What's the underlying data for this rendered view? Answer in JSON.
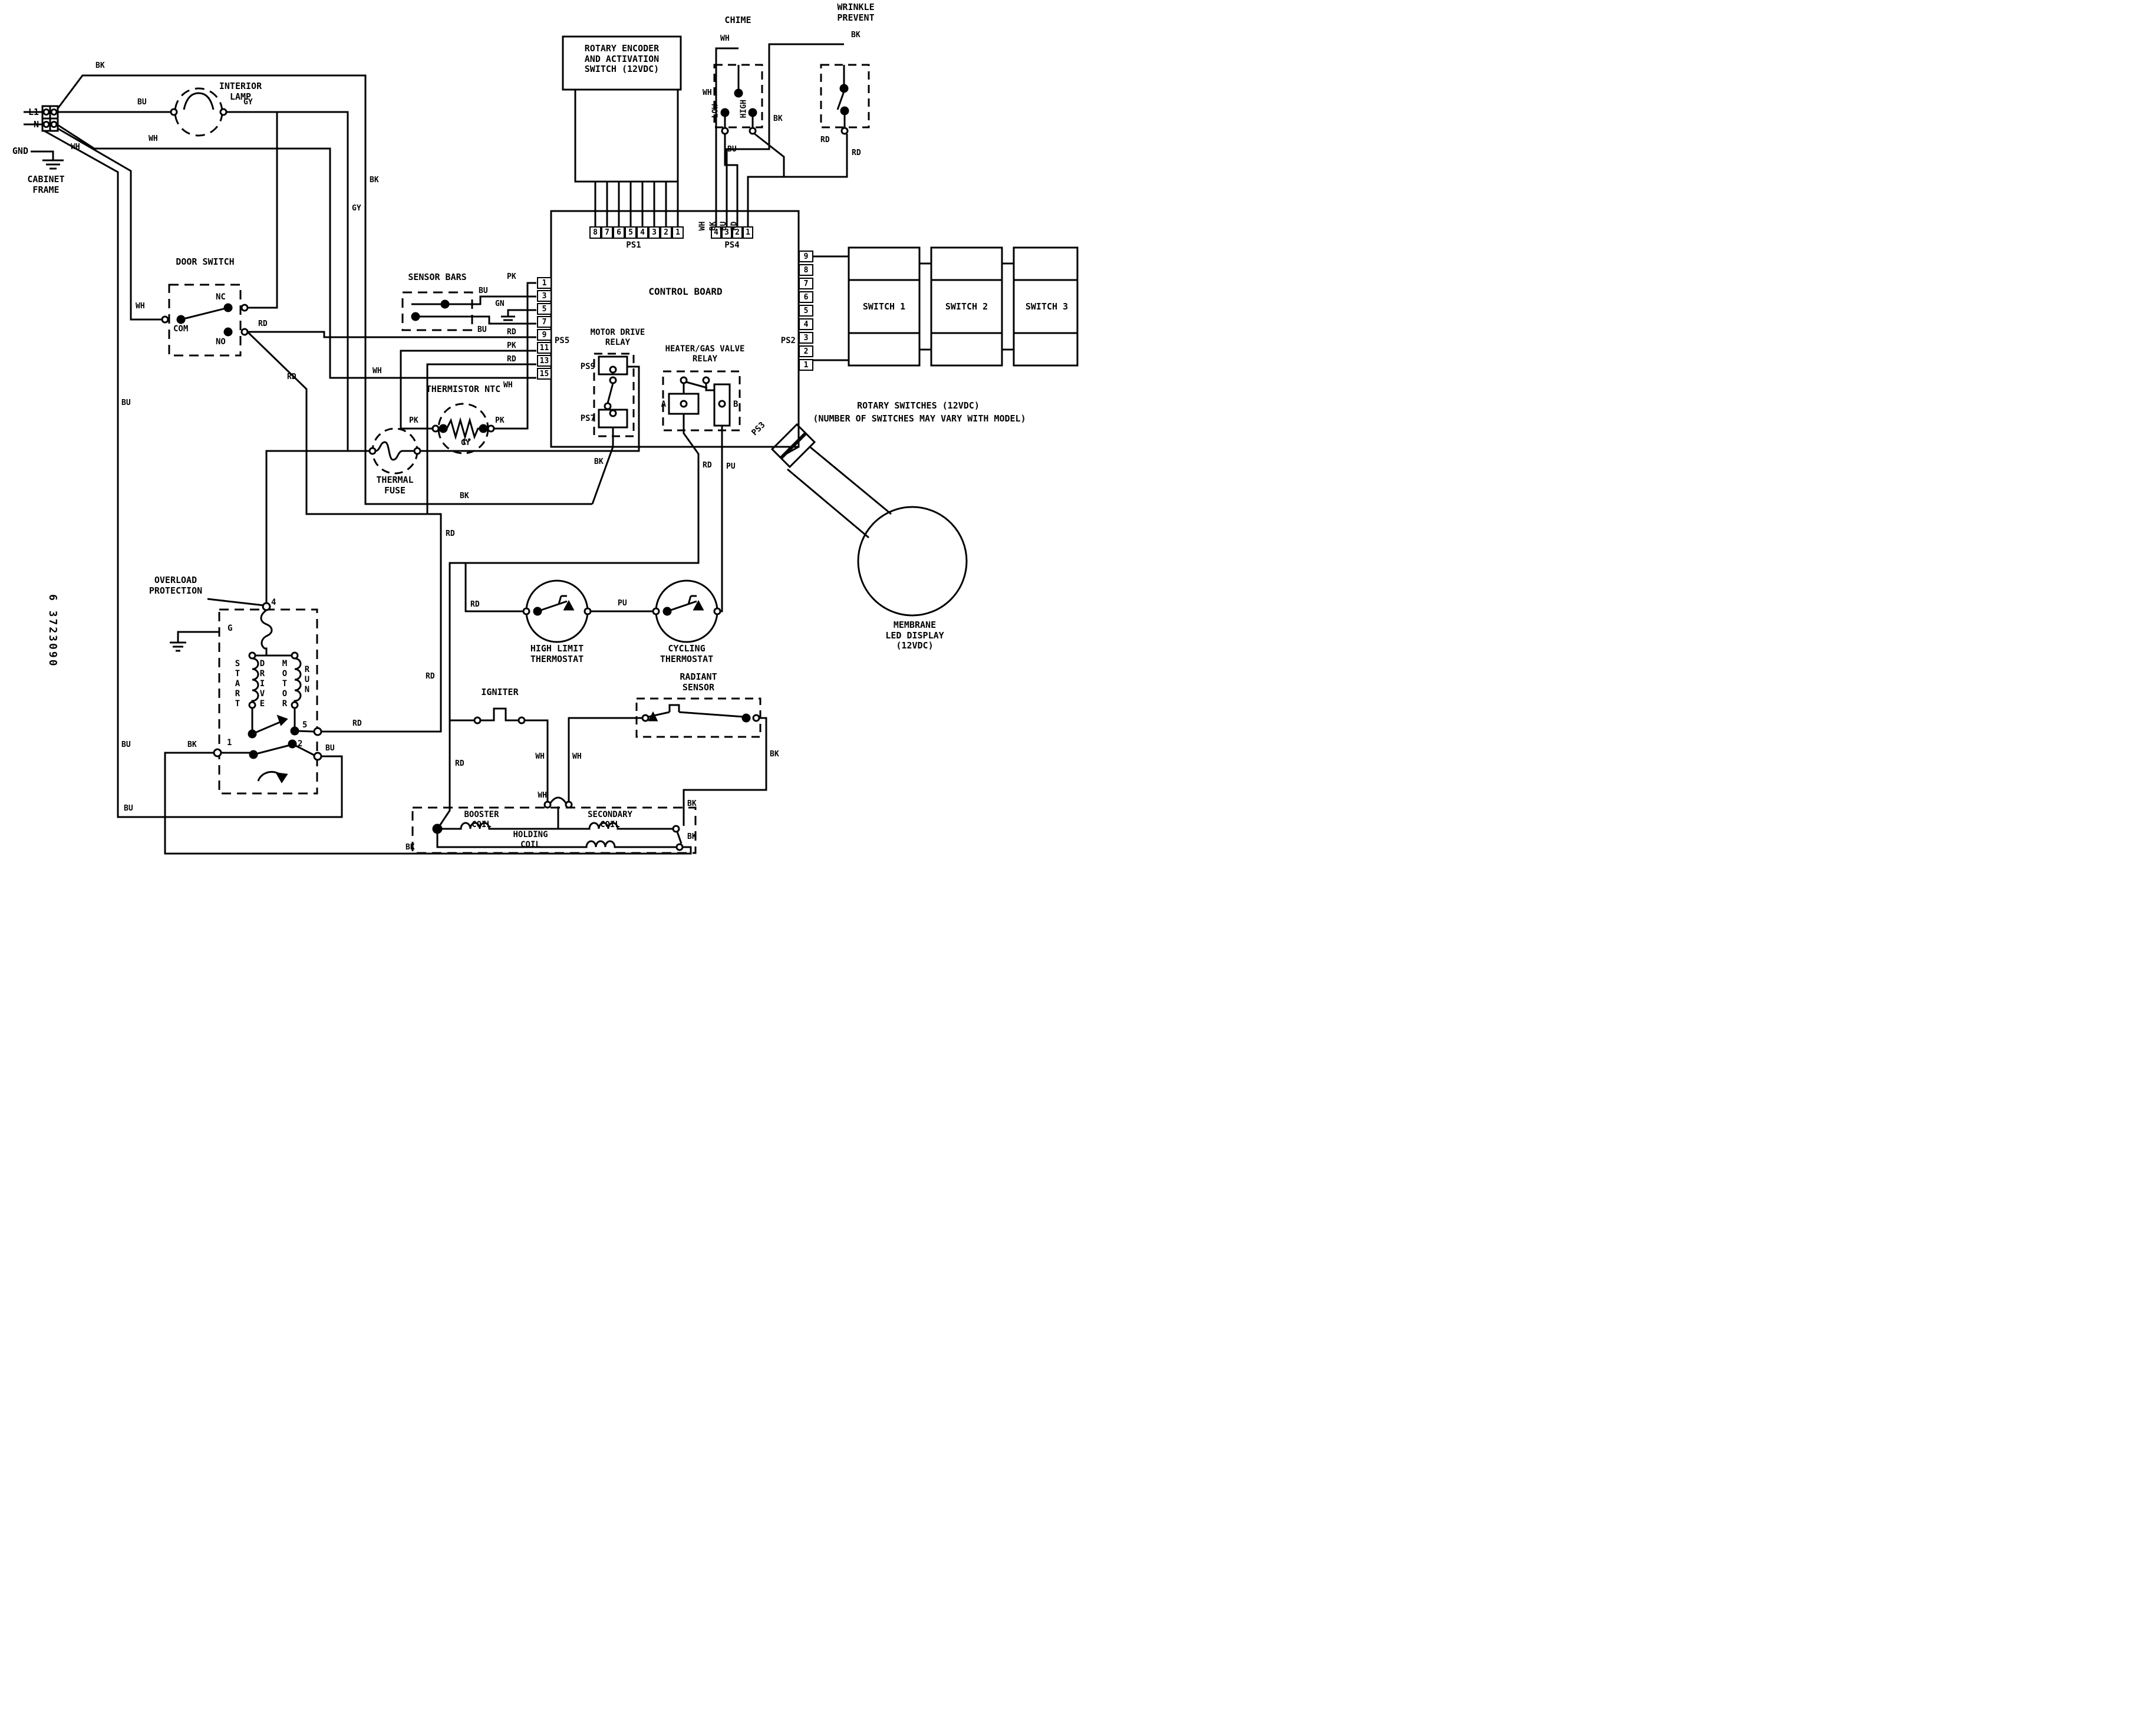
{
  "part_number": "6 3723090",
  "power": {
    "l1": "L1",
    "n": "N",
    "gnd": "GND",
    "cabinet_frame": "CABINET\nFRAME"
  },
  "components": {
    "interior_lamp": "INTERIOR\nLAMP",
    "door_switch": {
      "title": "DOOR SWITCH",
      "nc": "NC",
      "com": "COM",
      "no": "NO"
    },
    "sensor_bars": "SENSOR BARS",
    "thermistor": {
      "title": "THERMISTOR NTC",
      "temp": "t°"
    },
    "rotary_encoder": "ROTARY ENCODER\nAND ACTIVATION\nSWITCH (12VDC)",
    "chime": {
      "title": "CHIME",
      "low": "LOW",
      "high": "HIGH"
    },
    "wrinkle_prevent": "WRINKLE\nPREVENT",
    "control_board": "CONTROL BOARD",
    "motor_drive_relay": {
      "title": "MOTOR DRIVE\nRELAY",
      "ps9": "PS9",
      "ps7": "PS7"
    },
    "heater_relay": {
      "title": "HEATER/GAS VALVE\nRELAY",
      "a": "A",
      "b": "B"
    },
    "thermal_fuse": "THERMAL\nFUSE",
    "overload": "OVERLOAD\nPROTECTION",
    "motor": {
      "start": "START",
      "drive": "DRIVE",
      "motor": "MOTOR",
      "run": "RUN",
      "t4": "4",
      "t5": "5",
      "t1": "1",
      "t2": "2",
      "g": "G"
    },
    "high_limit": "HIGH LIMIT\nTHERMOSTAT",
    "cycling": "CYCLING\nTHERMOSTAT",
    "radiant_sensor": "RADIANT\nSENSOR",
    "igniter": "IGNITER",
    "booster_coil": "BOOSTER\nCOIL",
    "secondary_coil": "SECONDARY\nCOIL",
    "holding_coil": "HOLDING\nCOIL",
    "membrane": "MEMBRANE\nLED DISPLAY\n(12VDC)",
    "rotary_switches": {
      "caption": "ROTARY SWITCHES (12VDC)",
      "note": "(NUMBER OF SWITCHES MAY VARY WITH MODEL)",
      "s1": "SWITCH 1",
      "s2": "SWITCH 2",
      "s3": "SWITCH 3"
    }
  },
  "connectors": {
    "ps1": {
      "label": "PS1",
      "pins": [
        "8",
        "7",
        "6",
        "5",
        "4",
        "3",
        "2",
        "1"
      ]
    },
    "ps2": {
      "label": "PS2",
      "pins": [
        "9",
        "8",
        "7",
        "6",
        "5",
        "4",
        "3",
        "2",
        "1"
      ]
    },
    "ps3": {
      "label": "PS3"
    },
    "ps4": {
      "label": "PS4",
      "pins": [
        "4",
        "3",
        "2",
        "1"
      ],
      "wire_labels": [
        "WH",
        "BK",
        "BU",
        "RD"
      ]
    },
    "ps5": {
      "label": "PS5",
      "pins": [
        "1",
        "3",
        "5",
        "7",
        "9",
        "11",
        "13",
        "15"
      ]
    }
  },
  "wire_labels": {
    "bk_top": "BK",
    "bu_lamp": "BU",
    "gy_lamp": "GY",
    "wh_left_vert": "WH",
    "wh_horiz": "WH",
    "wh_com": "WH",
    "bu_left_upper": "BU",
    "bu_left_lower": "BU",
    "bu_bottom": "BU",
    "rd_no": "RD",
    "rd_no_diag": "RD",
    "rd_riser": "RD",
    "rd_motor5": "RD",
    "gy_vert": "GY",
    "bk_vert": "BK",
    "gy_fuse": "GY",
    "bk_relay_feed": "BK",
    "bk_drop": "BK",
    "pk_therm_left": "PK",
    "pk_therm_right": "PK",
    "pk_pin1": "PK",
    "bu_pin3": "BU",
    "gn_pin5": "GN",
    "bu_pin7": "BU",
    "rd_pin9": "RD",
    "pk_pin11": "PK",
    "rd_pin13": "RD",
    "wh_pin15": "WH",
    "wh_mid": "WH",
    "wh_chime": "WH",
    "bu_chime": "BU",
    "bk_wrinkle": "BK",
    "rd_wrinkle_a": "RD",
    "rd_wrinkle_b": "RD",
    "wh_ps4_riser": "WH",
    "bk_ps4_riser": "BK",
    "rd_a_drop": "RD",
    "pu_b_drop": "PU",
    "rd_highlimit": "RD",
    "pu_mid": "PU",
    "rd_igniter_feed": "RD",
    "rd_igniter_loop": "RD",
    "wh_igniter": "WH",
    "wh_radiant": "WH",
    "wh_hump": "WH",
    "bk_radiant": "BK",
    "bk_coil_exit": "BK",
    "bk_coil_jog": "BK",
    "bk_bottom": "BK",
    "bk_motor1": "BK",
    "bu_motor2": "BU"
  }
}
